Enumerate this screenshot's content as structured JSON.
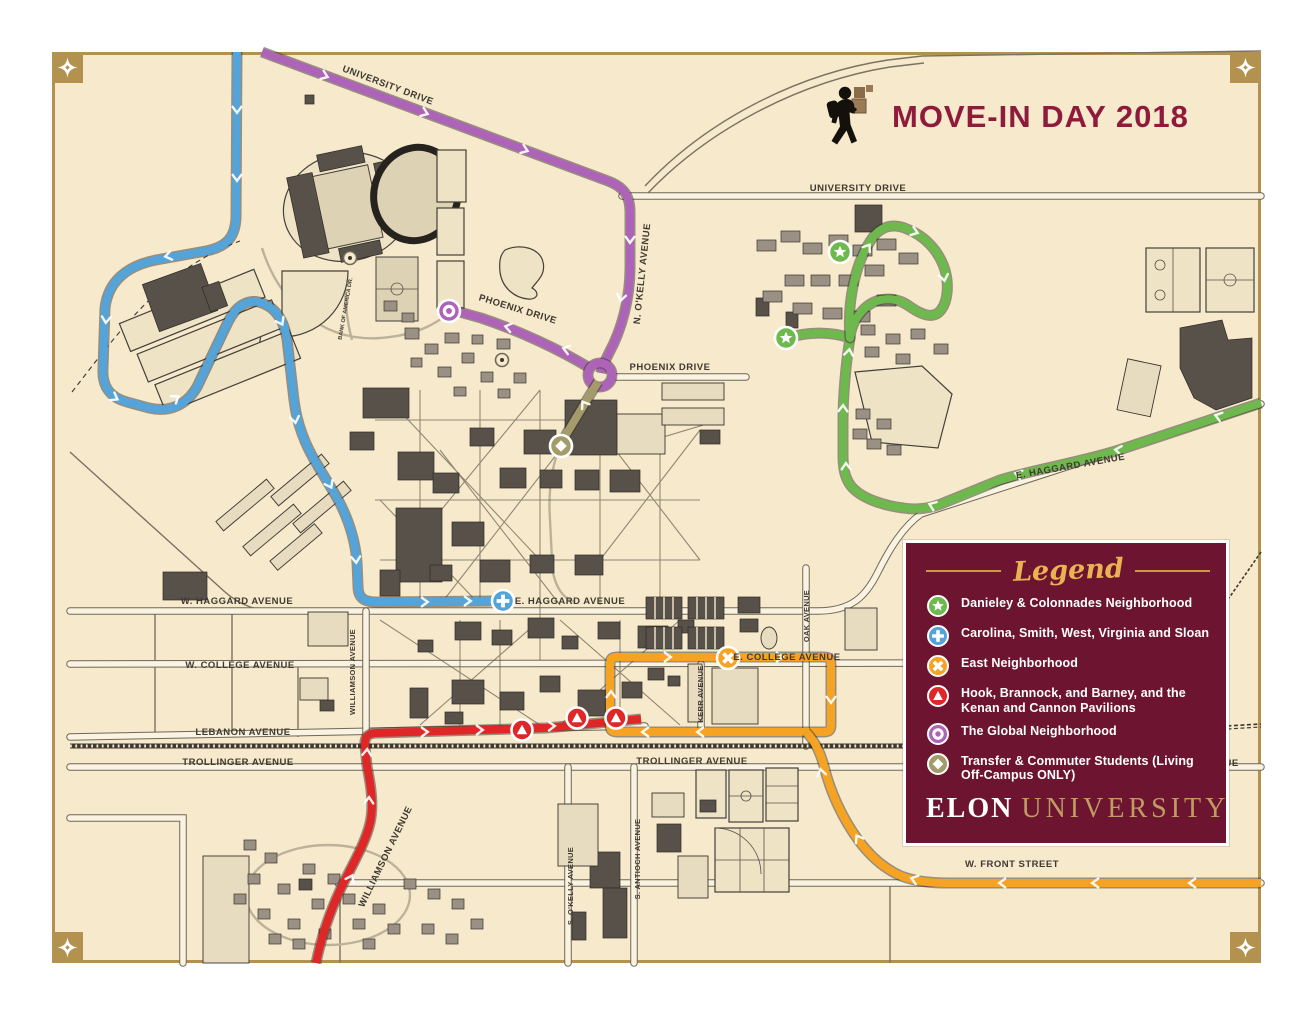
{
  "map": {
    "title": "MOVE-IN DAY 2018",
    "colors": {
      "background": "#f6e9cc",
      "border": "#b3924f",
      "title": "#8e1b3c",
      "building_dark": "#57514a",
      "building_gray": "#9a9184",
      "road": "#6f6757"
    }
  },
  "streets": {
    "university_drive": "UNIVERSITY DRIVE",
    "phoenix_drive": "PHOENIX DRIVE",
    "n_okelly_avenue": "N. O'KELLY AVENUE",
    "e_haggard_avenue": "E. HAGGARD AVENUE",
    "w_haggard_avenue": "W. HAGGARD AVENUE",
    "w_college_avenue": "W. COLLEGE AVENUE",
    "e_college_avenue": "E. COLLEGE AVENUE",
    "oak_avenue": "OAK AVENUE",
    "kerr_avenue": "KERR AVENUE",
    "williamson_avenue": "WILLIAMSON AVENUE",
    "lebanon_avenue": "LEBANON AVENUE",
    "trollinger_avenue": "TROLLINGER AVENUE",
    "w_front_street": "W. FRONT STREET",
    "s_okelly_avenue": "S. O'KELLY AVENUE",
    "s_antioch_avenue": "S. ANTIOCH AVENUE",
    "bank_of_america_dr": "BANK OF AMERICA DR."
  },
  "routes": {
    "global_purple": "#ad63b7",
    "carolina_blue": "#54a3d9",
    "danieley_green": "#6eb94d",
    "hook_red": "#de2726",
    "east_orange": "#f6a323",
    "transfer_olive": "#a39b69"
  },
  "legend": {
    "title": "Legend",
    "background": "#6d1530",
    "gold": "#eab253",
    "items": [
      {
        "icon": "star-badge",
        "color": "#6eb94d",
        "label": "Danieley & Colonnades Neighborhood"
      },
      {
        "icon": "plus-badge",
        "color": "#54a3d9",
        "label": "Carolina, Smith, West, Virginia and Sloan"
      },
      {
        "icon": "x-badge",
        "color": "#f6a323",
        "label": "East Neighborhood"
      },
      {
        "icon": "triangle-badge",
        "color": "#de2726",
        "label": "Hook, Brannock, and Barney, and  the Kenan and Cannon Pavilions"
      },
      {
        "icon": "ring-badge",
        "color": "#ad63b7",
        "label": "The Global Neighborhood"
      },
      {
        "icon": "diamond-badge",
        "color": "#a39b69",
        "label": "Transfer & Commuter Students (Living Off-Campus ONLY)"
      }
    ],
    "brand": {
      "elon": "ELON",
      "university": "UNIVERSITY"
    }
  }
}
